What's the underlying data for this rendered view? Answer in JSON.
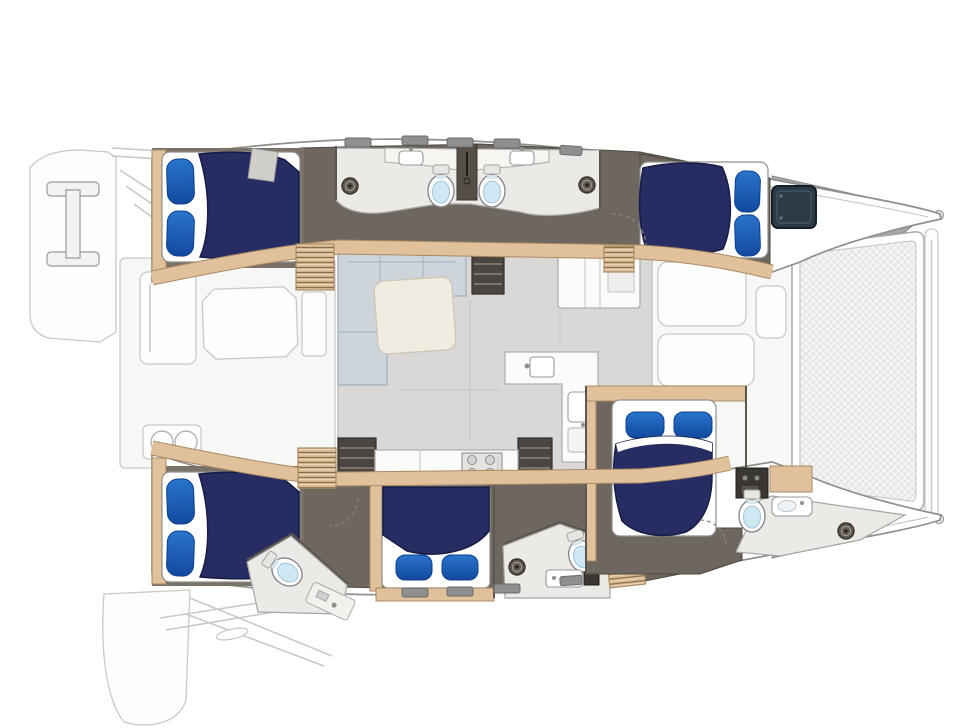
{
  "meta": {
    "type": "floor-plan-diagram",
    "subject": "sailing catamaran interior layout, overhead plan view",
    "orientation": {
      "bow": "right",
      "stern": "left"
    },
    "canvas": {
      "width": 971,
      "height": 728
    },
    "visible_text": "none"
  },
  "colors": {
    "background": "#ffffff",
    "hull_fill": "#ffffff",
    "hull_outline": "#8f8f8d",
    "deck_ghost": "#f7f7f6",
    "ghost_line": "#c9c9c7",
    "salon_floor": "#d9d8d6",
    "walkway_floor": "#6e675f",
    "bathroom_floor": "#ebeae6",
    "wood_light": "#e0c19c",
    "wood_dark": "#a98a63",
    "bed_navy": "#272c62",
    "bed_navy_dark": "#171b45",
    "pillow_blue": "#2a74cc",
    "pillow_blue_dark": "#124a9e",
    "mattress_white": "#ffffff",
    "toilet_lid": "#cfe8f4",
    "hatch_dark": "#2c3a46",
    "stair_dark": "#4a4540",
    "couch_fill": "#cdd5db",
    "couch_line": "#a3b2bf",
    "table_fill": "#f1ece2",
    "counter_white": "#fbfbfa",
    "gray_mid": "#a8a8a6",
    "trampoline_line": "#d2d2d0"
  },
  "features": {
    "hulls": [
      {
        "id": "top-hull",
        "cabins": 2,
        "heads": 2
      },
      {
        "id": "bottom-hull",
        "cabins": 3,
        "heads": 3
      }
    ],
    "cabins": [
      {
        "id": "top-aft-cabin",
        "bed": "double",
        "pillows": 2,
        "pillow_side": "left"
      },
      {
        "id": "top-fwd-cabin",
        "bed": "double",
        "pillows": 2,
        "pillow_side": "right",
        "extras": [
          "deck-hatch"
        ]
      },
      {
        "id": "bottom-aft-cabin",
        "bed": "double",
        "pillows": 2,
        "pillow_side": "left"
      },
      {
        "id": "bottom-mid-cabin",
        "bed": "double",
        "pillows": 2,
        "pillow_side": "bottom"
      },
      {
        "id": "bottom-fwd-cabin",
        "bed": "double",
        "pillows": 2,
        "pillow_side": "top"
      }
    ],
    "bathrooms": [
      {
        "id": "top-head-aft",
        "fixtures": [
          "vanity-sink",
          "toilet",
          "shower-drain"
        ]
      },
      {
        "id": "top-head-fwd",
        "fixtures": [
          "vanity-sink",
          "toilet",
          "shower-drain"
        ]
      },
      {
        "id": "bottom-aft-head",
        "fixtures": [
          "toilet",
          "vanity-counter"
        ]
      },
      {
        "id": "bottom-mid-head",
        "fixtures": [
          "toilet",
          "sink",
          "shower-drain",
          "panel"
        ]
      },
      {
        "id": "bottom-fwd-head",
        "fixtures": [
          "toilet",
          "sink",
          "shower-drain",
          "cabinet",
          "shelf"
        ]
      }
    ],
    "salon": {
      "furniture": [
        "l-settee",
        "coffee-table",
        "storage-cabinet",
        "galley-island-with-sink",
        "galley-basin-counter",
        "aft-galley-counter",
        "cooktop",
        "companionway-stairs-top",
        "companionway-stairs-bottom",
        "louvered-steps"
      ]
    },
    "exterior": {
      "aft": [
        "swim-platform-top",
        "swim-platform-bottom",
        "transom-steps",
        "cockpit-bench",
        "cockpit-table",
        "grill-two-burners",
        "cockpit-seats"
      ],
      "fwd": [
        "foredeck-lounge-pads",
        "anchor-lockers",
        "trampoline-net",
        "forward-beam-plank",
        "bow-fittings"
      ]
    },
    "counts": {
      "beds": 5,
      "toilets": 5,
      "bathroom_sinks": 4,
      "shower_drains": 4,
      "deck_hatches": 9,
      "galley_sinks": 2
    }
  }
}
